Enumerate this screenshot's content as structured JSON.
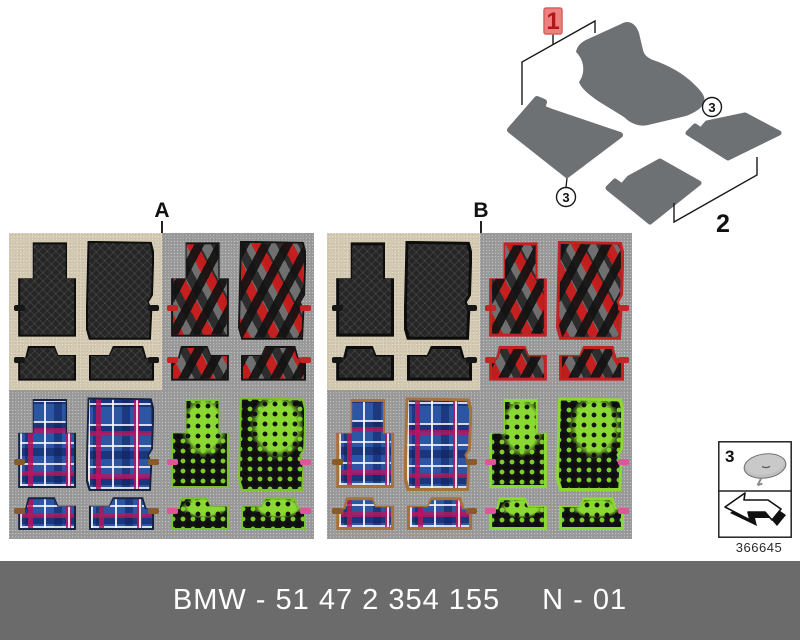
{
  "diagram": {
    "callouts": {
      "one": "1",
      "two": "2",
      "three": "3"
    }
  },
  "panels": {
    "a_label": "A",
    "b_label": "B"
  },
  "legend": {
    "item": "3",
    "drawing_number": "366645"
  },
  "footer": {
    "part_text": "BMW - 51 47 2 354 155",
    "revision_text": "N - 01"
  },
  "colors": {
    "highlight_red": "#ef8080",
    "callout_text_red": "#b01818",
    "accent_red_trim": "#c32222",
    "beige_background": "#d3c9b2",
    "gray_background": "#9b9b9b",
    "drawing_mat_gray": "#6e7173",
    "footer_bar_gray": "#6b6b6b",
    "plaid_blue": "#2c55a4",
    "green_accent": "#8ad932"
  }
}
